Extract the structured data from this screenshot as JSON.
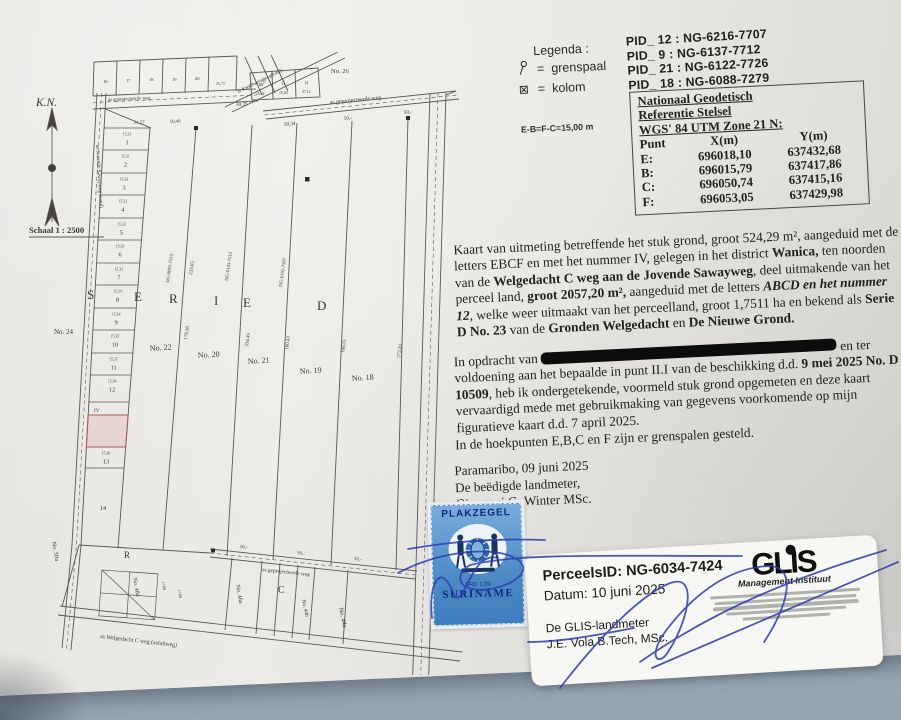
{
  "legend": {
    "title": "Legenda :",
    "eq": "=",
    "items": [
      {
        "label": "grenspaal"
      },
      {
        "label": "kolom"
      }
    ],
    "kolom_symbol": "⊠"
  },
  "pid_list": [
    "PID_ 12 : NG-6216-7707",
    "PID_ 9  : NG-6137-7712",
    "PID_ 21 : NG-6122-7726",
    "PID_ 18 : NG-6088-7279"
  ],
  "coordinate_table": {
    "title_lines": [
      "Nationaal Geodetisch",
      "Referentie Stelsel",
      "WGS' 84 UTM Zone 21 N:"
    ],
    "headers": [
      "Punt",
      "X(m)",
      "Y(m)"
    ],
    "rows": [
      [
        "E:",
        "696018,10",
        "637432,68"
      ],
      [
        "B:",
        "696015,79",
        "637417,86"
      ],
      [
        "C:",
        "696050,74",
        "637415,16"
      ],
      [
        "F:",
        "696053,05",
        "637429,98"
      ]
    ]
  },
  "note_eb": "E-B=F-C=15,00 m",
  "paragraphs": {
    "p1": [
      {
        "t": "Kaart van uitmeting betreffende het stuk grond, groot 524,29 m², aangeduid met de letters EBCF en met het nummer IV, gelegen in het district "
      },
      {
        "t": "Wanica,"
      },
      {
        "t": " ten noorden van de "
      },
      {
        "t": "Welgedacht C weg aan de Jovende Sawayweg"
      },
      {
        "t": ", deel uitmakende van het perceel land, "
      },
      {
        "t": "groot 2057,20 m²,"
      },
      {
        "t": " aangeduid met de letters "
      },
      {
        "t": "ABCD en het nummer 12"
      },
      {
        "t": ",  welke weer uitmaakt van het perceelland, groot 1,7511 ha en bekend als "
      },
      {
        "t": "Serie D No. 23"
      },
      {
        "t": " van de "
      },
      {
        "t": "Gronden Welgedacht"
      },
      {
        "t": " en "
      },
      {
        "t": "De Nieuwe Grond."
      }
    ],
    "p2": [
      {
        "t": "In opdracht van "
      },
      {
        "t": " en ter voldoening aan het bepaalde in punt II.I van de beschikking d.d. "
      },
      {
        "t": "9 mei 2025 No. D 10509"
      },
      {
        "t": ", heb ik ondergetekende, voormeld stuk grond opgemeten en deze kaart vervaardigd mede met gebruikmaking van gegevens voorkomende op mijn figuratieve kaart d.d. 7 april 2025."
      }
    ],
    "p3": "In de hoekpunten E,B,C en F zijn er grenspalen gesteld."
  },
  "signature_block": {
    "place_date": "Paramaribo, 09 juni 2025",
    "role": "De beëdigde landmeter,",
    "name": "Giovanni G. Winter MSc."
  },
  "stamp": {
    "title": "PLAKZEGEL",
    "value": "SRD 1,00",
    "country": "SURINAME"
  },
  "glis_card": {
    "perceel_id": "PerceelsID: NG-6034-7424",
    "datum": "Datum: 10 juni 2025",
    "role": "De GLIS-landmeter",
    "name": "J.E. Vola B.Tech, MSc.",
    "logo": "GLIS",
    "logo_sub": "Management Instituut"
  },
  "map": {
    "north_label": "K.N.",
    "scale_label": "Schaal 1 : 2500",
    "road_left": "as Jovende Sawayweg (zand)",
    "road_top_left": "as geprojecteerde weg",
    "road_top_right": "as geprojecteerde weg",
    "road_bottom": "as geprojecteerde weg",
    "road_kwarta": "as Kwartagrindweg(zand)",
    "road_welgedacht": "as Welgedacht C weg (asfaltweg)",
    "big_letters": [
      "S",
      "E",
      "R",
      "I",
      "E",
      "D"
    ],
    "strip_labels": [
      "No. 22",
      "No. 20",
      "No. 21",
      "No. 19",
      "No. 18"
    ],
    "label_left": "No. 24",
    "label_top": "No. 26",
    "label_road_end": "No. 50a",
    "bottom_labels": [
      "R",
      "No. 48a",
      "No. 46a",
      "C",
      "No. 44b",
      "No. 44a"
    ],
    "pink_ids": [
      "NG-6091-7512",
      "NG-6143-7512",
      "NG-6192-7507"
    ],
    "line_dims": [
      "229,65",
      "178,38",
      "334,49",
      "160,43",
      "166,31",
      "372,20"
    ],
    "top_dims": [
      "51,57",
      "50,46",
      "50,35",
      "50,34",
      "50,-",
      "50,-"
    ],
    "bottom_dims": [
      "50,-",
      "50,-",
      "50,-"
    ],
    "top_parcels": [
      "16",
      "17",
      "18",
      "19",
      "20"
    ],
    "top_parcel_dim": "25,75",
    "top_right_parcels": [
      "10",
      "11",
      "12"
    ],
    "top_right_dims": [
      "16,02",
      "15,30",
      "47,12"
    ],
    "diag_dims": [
      "13,71",
      "15,08"
    ],
    "small_dims": [
      "17,08",
      "17,08"
    ],
    "highlight_label": "IV",
    "left_parcels": [
      {
        "n": "1",
        "d": "15,31"
      },
      {
        "n": "2",
        "d": "15,31"
      },
      {
        "n": "3",
        "d": "15,32"
      },
      {
        "n": "4",
        "d": "15,32"
      },
      {
        "n": "5",
        "d": "15,33"
      },
      {
        "n": "6",
        "d": "15,33"
      },
      {
        "n": "7",
        "d": "15,33"
      },
      {
        "n": "8",
        "d": "15,34"
      },
      {
        "n": "9",
        "d": "15,34"
      },
      {
        "n": "10",
        "d": "15,35"
      },
      {
        "n": "11",
        "d": "15,35"
      },
      {
        "n": "12",
        "d": "15,36"
      },
      {
        "n": "13",
        "d": "15,36"
      },
      {
        "n": "14",
        "d": ""
      }
    ]
  }
}
